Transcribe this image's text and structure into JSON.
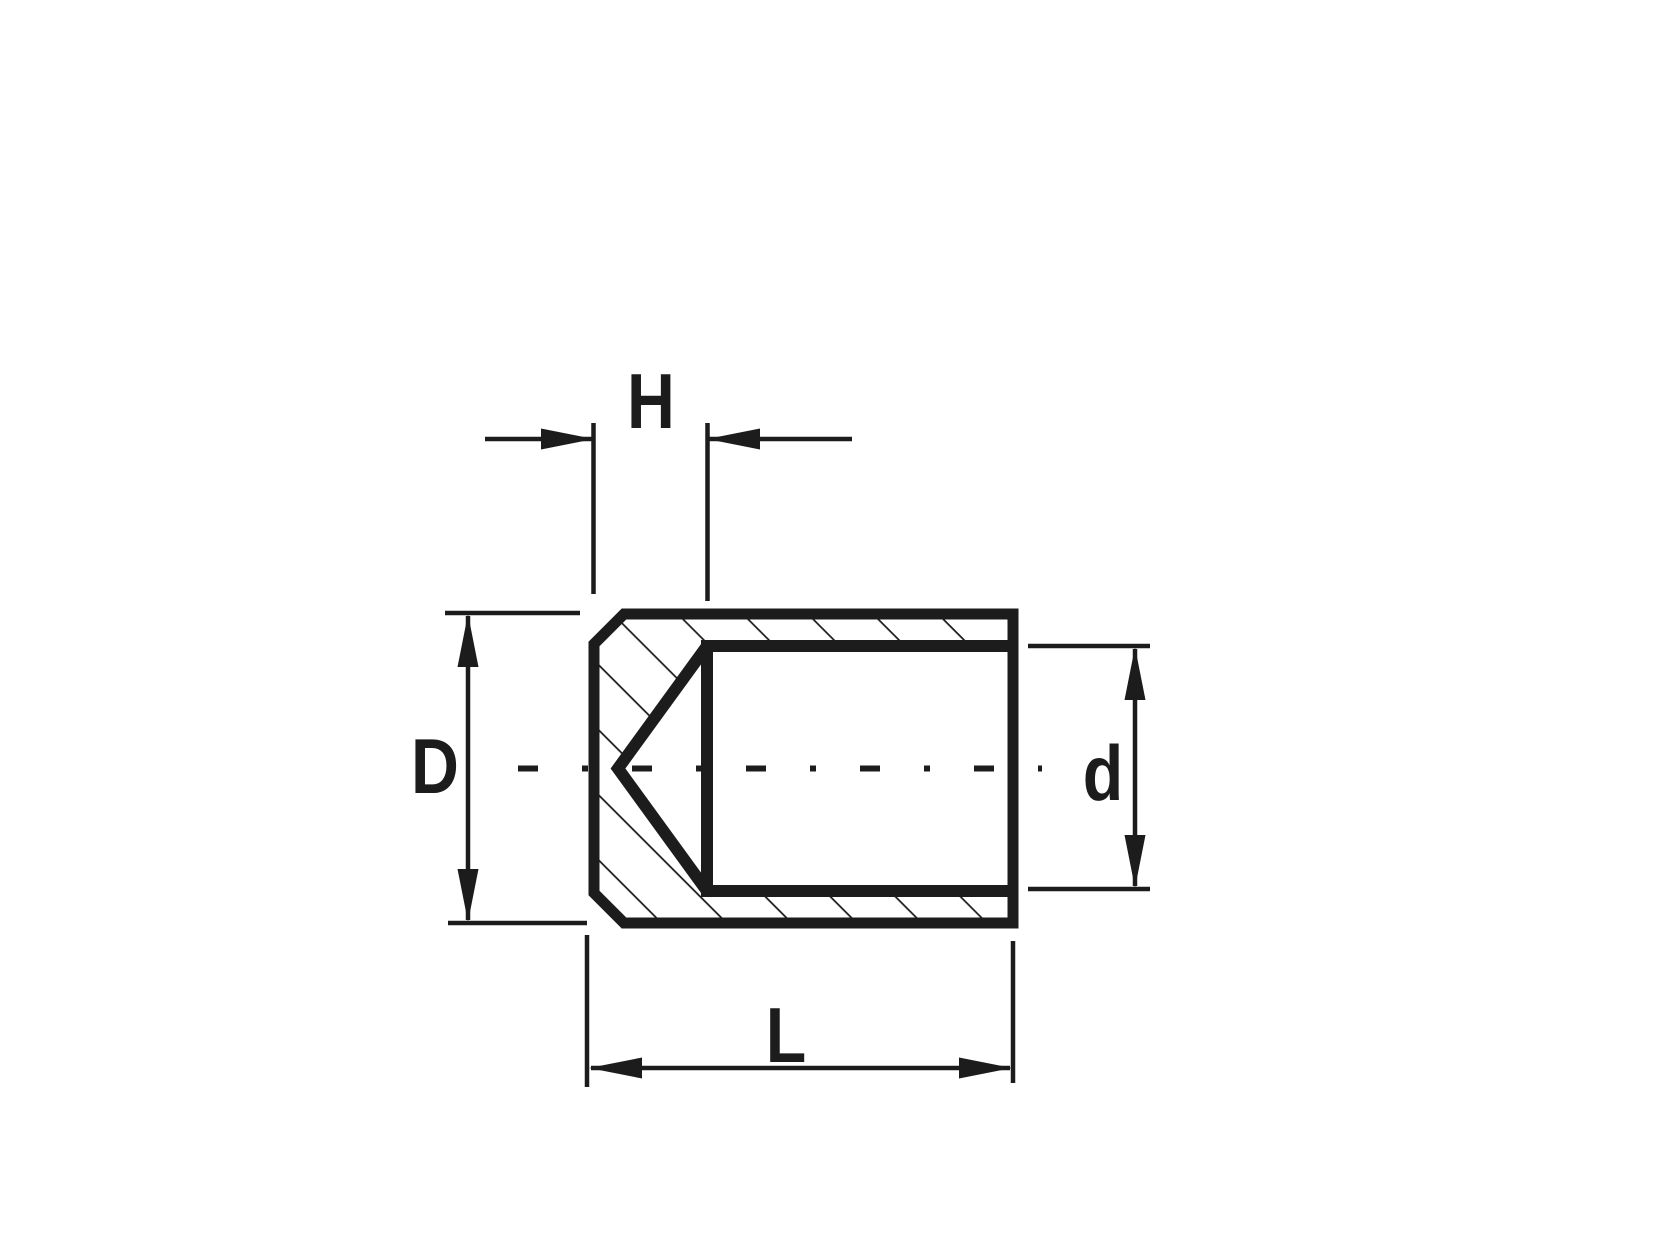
{
  "drawing": {
    "background_color": "#ffffff",
    "line_color": "#1c1c1c",
    "dimension_labels": {
      "top": "H",
      "left": "D",
      "right": "d",
      "bottom": "L"
    }
  }
}
